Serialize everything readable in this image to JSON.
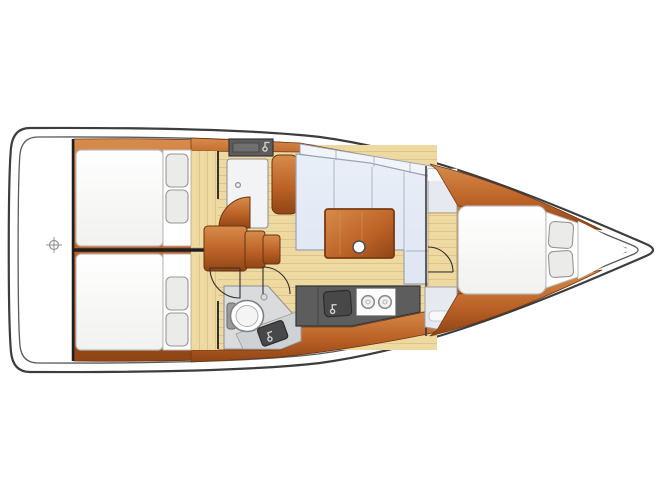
{
  "meta": {
    "title": "Sailboat interior layout — top-down floor plan, bow pointing right, no text labels"
  },
  "palette": {
    "page-bg": "#ffffff",
    "hull-stroke": "#3d3d3d",
    "hull-inner-stroke": "#5a5a5a",
    "wood-light": "#d78c4b",
    "wood-mid": "#bc6227",
    "wood-dark": "#8f4515",
    "wood-edge": "#6b3310",
    "floor-tan": "#eed9a0",
    "floor-stripe": "#c9ab6e",
    "berth-white": "#fcfcfc",
    "berth-stroke": "#b9b9b9",
    "pillow-fill": "#ebebe9",
    "pillow-stroke": "#979797",
    "cushion-fill": "#dfe6f2",
    "cushion-stroke": "#9aa2b4",
    "backrest-fill": "#f1f4f9",
    "counter-dark": "#5d5d5d",
    "counter-stroke": "#353535",
    "appliance-dark": "#484848",
    "stove-white": "#fcfcfc",
    "panel-light": "#e6eaf0",
    "head-floor": "#d9dbdd",
    "bulkhead": "#1f1f1f",
    "metal-gray": "#d6d6d6"
  },
  "rooms": [
    {
      "id": "transom",
      "name": "stern-swim-platform"
    },
    {
      "id": "aft-cabin-top",
      "name": "aft-double-berth-cabin"
    },
    {
      "id": "aft-cabin-bottom",
      "name": "aft-double-berth-cabin"
    },
    {
      "id": "aft-head",
      "name": "shower-head-compartment-with-sink"
    },
    {
      "id": "companionway",
      "name": "companionway-steps"
    },
    {
      "id": "salon",
      "name": "salon-with-l-shaped-settee-and-table"
    },
    {
      "id": "head",
      "name": "head-with-toilet-and-corner-sink"
    },
    {
      "id": "galley",
      "name": "galley-with-sink-and-two-burner-stove"
    },
    {
      "id": "forward-cabin",
      "name": "forward-v-berth-cabin"
    }
  ],
  "features": {
    "aft_berths": 2,
    "pillows_per_aft_berth": 2,
    "forward_pillows": 2,
    "stove_burners": 2,
    "sinks": 3,
    "toilets": 1,
    "door_swings": 4,
    "companionway_steps": 3,
    "table_pedestals": 1
  }
}
